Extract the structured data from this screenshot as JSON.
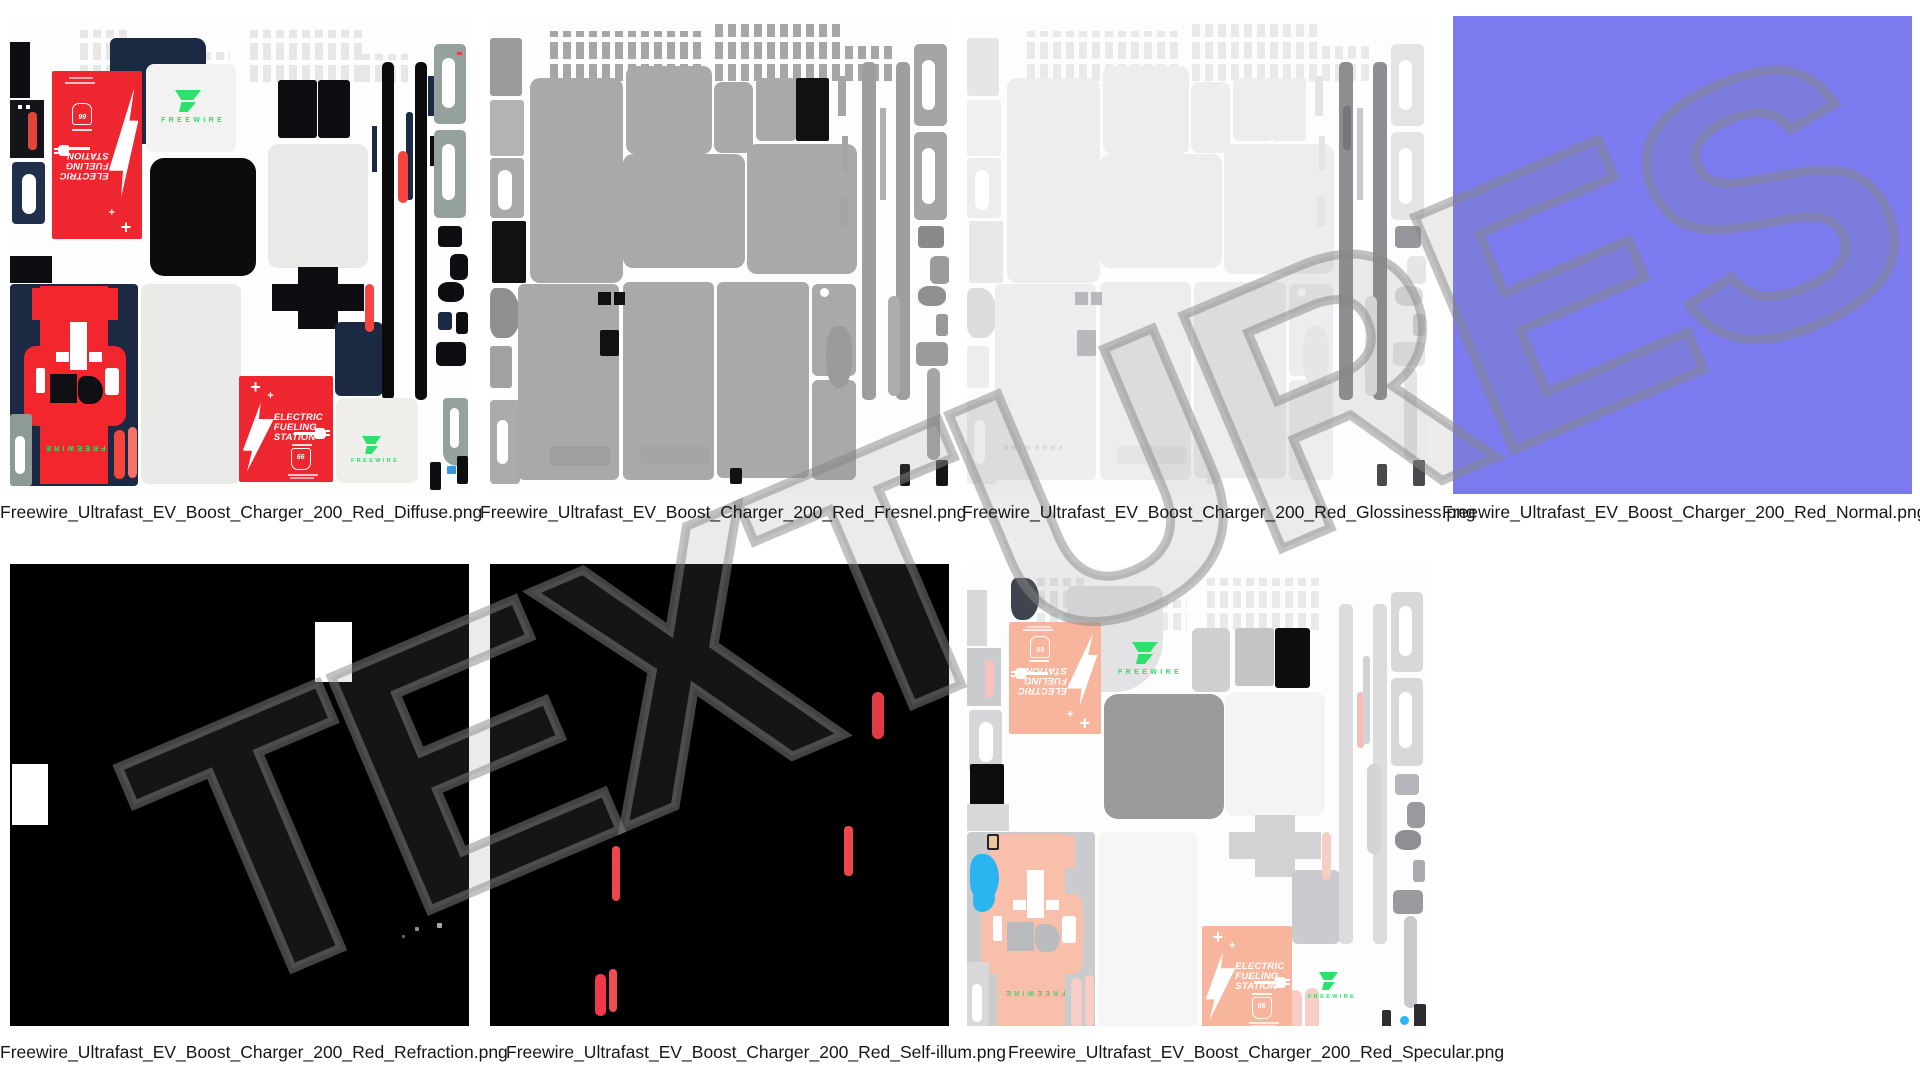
{
  "watermark": "TEXTURES",
  "files": [
    "Freewire_Ultrafast_EV_Boost_Charger_200_Red_Diffuse.png",
    "Freewire_Ultrafast_EV_Boost_Charger_200_Red_Fresnel.png",
    "Freewire_Ultrafast_EV_Boost_Charger_200_Red_Glossiness.png",
    "Freewire_Ultrafast_EV_Boost_Charger_200_Red_Normal.png",
    "Freewire_Ultrafast_EV_Boost_Charger_200_Red_Refraction.png",
    "Freewire_Ultrafast_EV_Boost_Charger_200_Red_Self-illum.png",
    "Freewire_Ultrafast_EV_Boost_Charger_200_Red_Specular.png"
  ],
  "brand": {
    "name": "FREEWIRE"
  },
  "efs": {
    "line1": "ELECTRIC",
    "line2": "FUELING",
    "line3": "STATION",
    "badge": "66",
    "plus_large": "+",
    "plus_small": "+"
  },
  "colors": {
    "diffuse_red": "#ee2630",
    "navy": "#1b2a42",
    "freewire_green": "#2ee06c",
    "normal_map_blue": "#7b7bef",
    "specular_salmon": "#f7b59d",
    "self_illum_red": "#ee3a40",
    "accent_blue": "#2ab4f0",
    "watermark_gray": "#868686"
  }
}
